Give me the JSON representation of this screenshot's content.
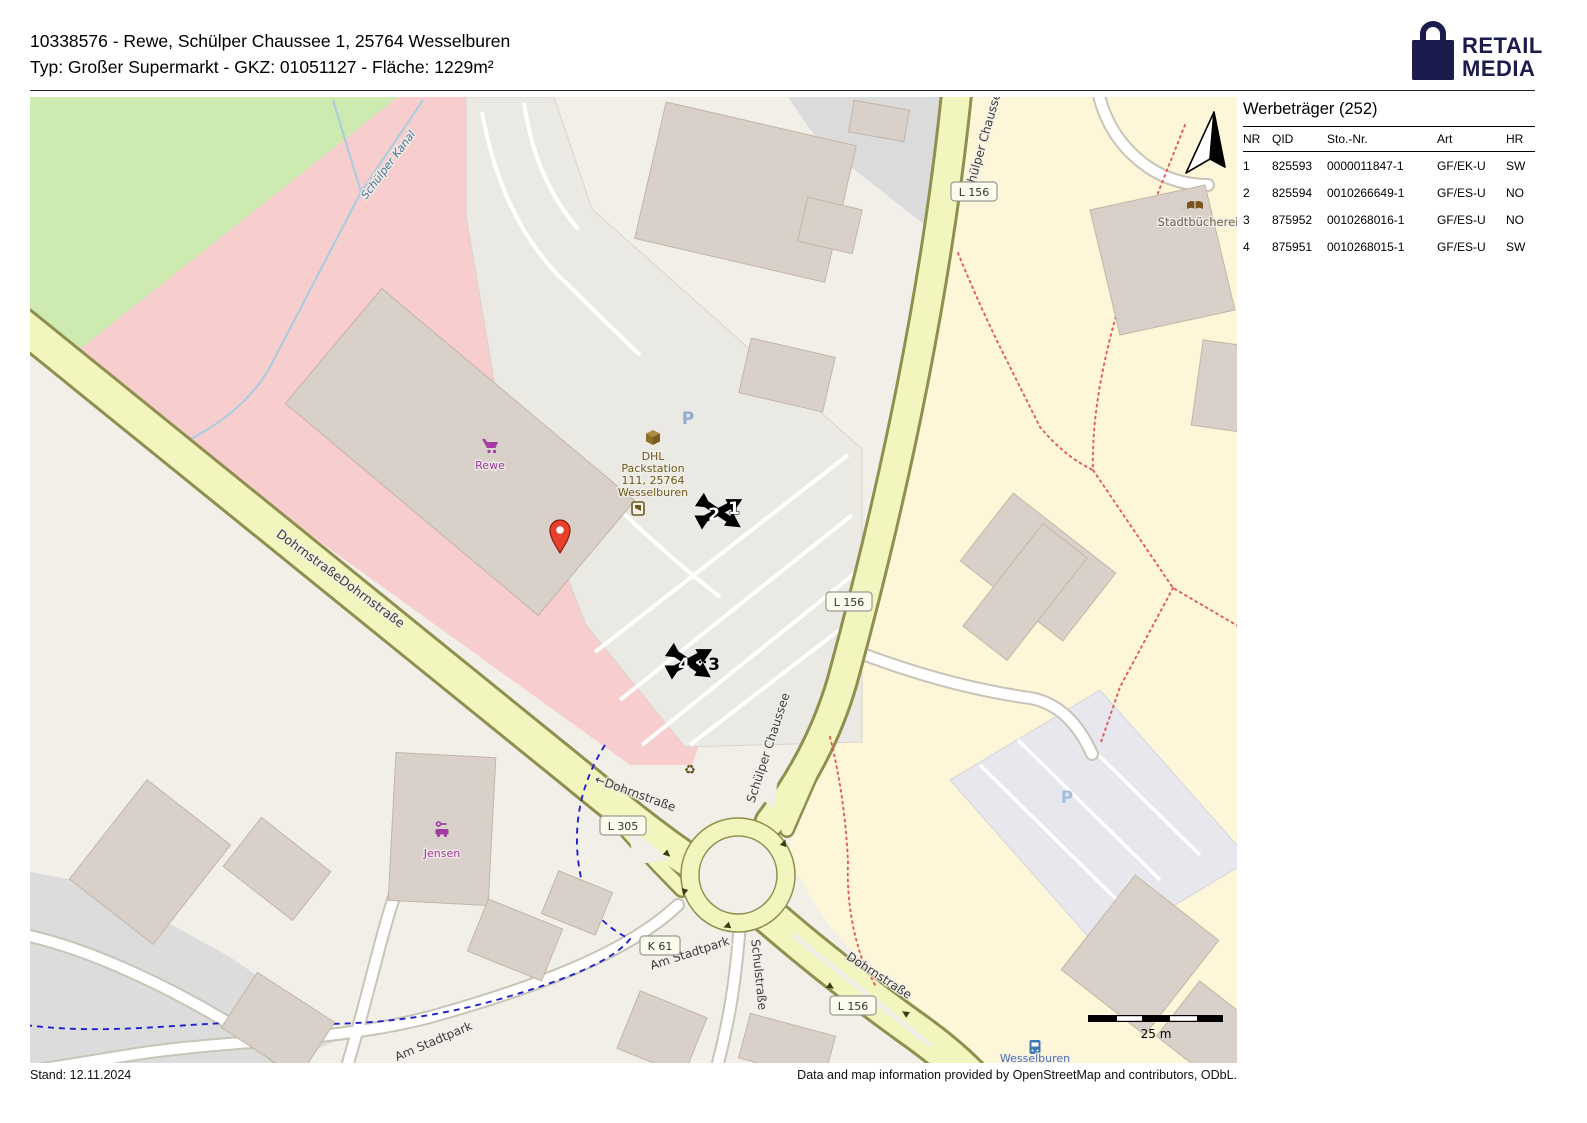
{
  "header": {
    "line1": "10338576 - Rewe, Schülper Chaussee 1, 25764 Wesselburen",
    "line2": "Typ: Großer Supermarkt - GKZ: 01051127 - Fläche: 1229m²"
  },
  "logo": {
    "line1": "RETAIL",
    "line2": "MEDIA"
  },
  "panel": {
    "title": "Werbeträger (252)",
    "columns": [
      "NR",
      "QID",
      "Sto.-Nr.",
      "Art",
      "HR"
    ],
    "rows": [
      [
        "1",
        "825593",
        "0000011847-1",
        "GF/EK-U",
        "SW"
      ],
      [
        "2",
        "825594",
        "0010266649-1",
        "GF/ES-U",
        "NO"
      ],
      [
        "3",
        "875952",
        "0010268016-1",
        "GF/ES-U",
        "NO"
      ],
      [
        "4",
        "875951",
        "0010268015-1",
        "GF/ES-U",
        "SW"
      ]
    ]
  },
  "footer": {
    "left": "Stand: 12.11.2024",
    "right": "Data and map information provided by OpenStreetMap and contributors, ODbL."
  },
  "map": {
    "streets": {
      "kanal": "Schülper Kanal",
      "dohrnstrasse_double": "DohrnstraßeDohrnstraße",
      "dohrnstrasse_w": "←Dohrnstraße",
      "dohrnstrasse_se": "Dohrnstraße",
      "schuelper_chaussee": "Schülper Chaussee",
      "schulstrasse": "Schulstraße",
      "am_stadtpark": "Am Stadtpark"
    },
    "badges": {
      "l156": "L 156",
      "l305": "L 305",
      "k61": "K 61"
    },
    "pois": {
      "rewe": "Rewe",
      "dhl": [
        "DHL",
        "Packstation",
        "111, 25764",
        "Wesselburen"
      ],
      "jensen": "Jensen",
      "stadtbuecherei": "Stadtbücherei",
      "wesselburen_stop": "Wesselburen",
      "parking": "P"
    },
    "markers": [
      "1",
      "2",
      "3",
      "4"
    ],
    "scalebar": "25 m"
  },
  "colors": {
    "brand_navy": "#1b1b4e",
    "map_bg": "#f2efe9",
    "area_green": "#cdebb0",
    "area_pink": "#f7cdcd",
    "area_yellow": "#fdf6d8",
    "road_fill": "#f2f5bd",
    "road_casing": "#8f8f4f",
    "building": "#d9d0c9",
    "water": "#a6cde0",
    "cycleway": "#2020cc",
    "footpath": "#e05a5a",
    "poi_purple": "#a23ba2",
    "poi_brown": "#6f5a1f",
    "marker_black": "#000000",
    "pin_red": "#e8402a",
    "parking_p": "#90acd4"
  }
}
